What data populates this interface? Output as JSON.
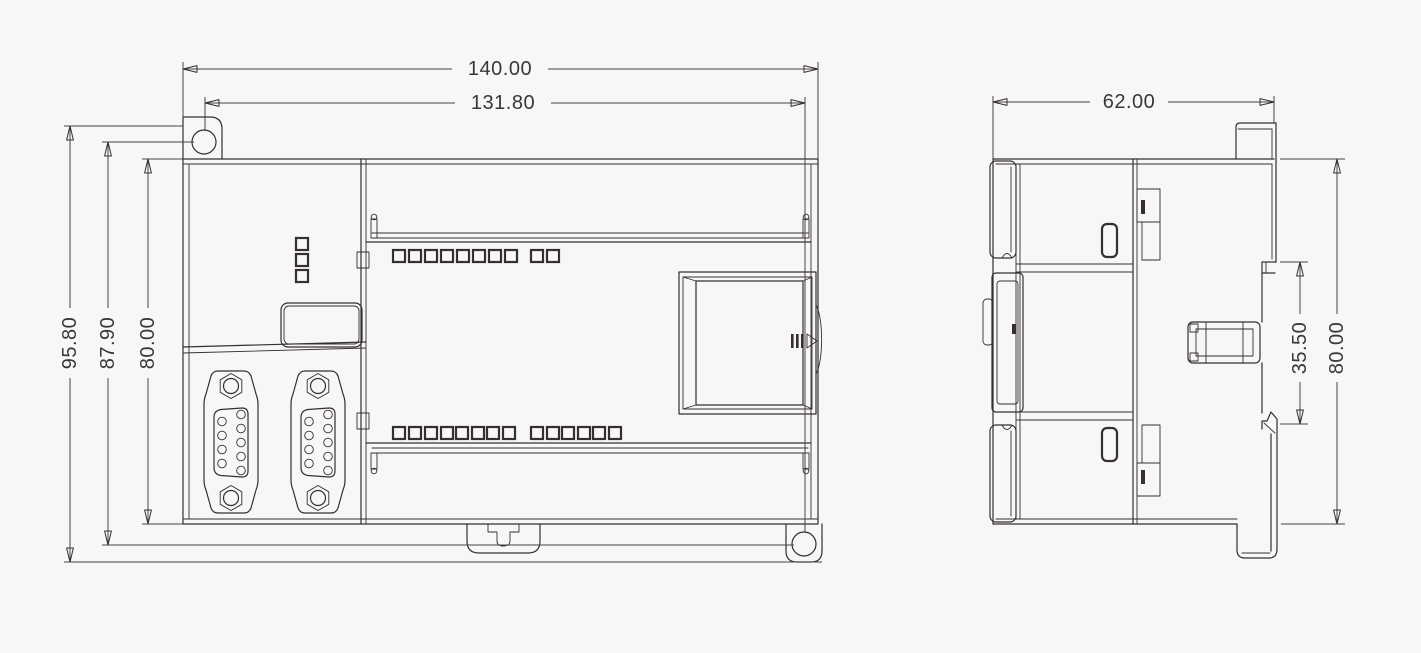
{
  "drawing": {
    "background_color": "#f7f7f7",
    "line_color": "#362f2d",
    "text_color": "#3c3737",
    "views": {
      "front": {
        "label": "front-view-of-plc-enclosure",
        "dimensions": {
          "overall_width": "140.00",
          "mounting_hole_span_width": "131.80",
          "overall_height": "95.80",
          "mounting_hole_span_height": "87.90",
          "body_height": "80.00"
        },
        "features": {
          "status_led_column_count": 3,
          "upper_led_row_counts": [
            8,
            2
          ],
          "lower_led_row_counts": [
            8,
            6
          ],
          "db9_connector_count": 2,
          "db9_pin_count": 9,
          "mounting_hole_count": 2
        }
      },
      "side": {
        "label": "side-view-of-plc-enclosure",
        "dimensions": {
          "overall_depth": "62.00",
          "din_latch_span": "35.50",
          "body_height": "80.00"
        }
      }
    }
  }
}
